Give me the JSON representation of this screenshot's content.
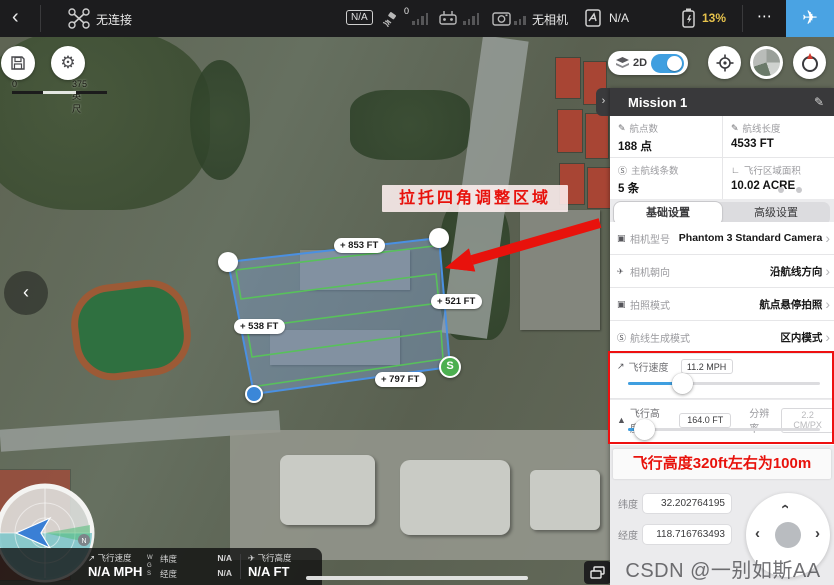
{
  "colors": {
    "accent_blue": "#3f9fe0",
    "battery_yellow": "#e6c24c",
    "alert_red": "#ee1010",
    "route_green": "#58c15b",
    "polygon_blue": "#4a90e2"
  },
  "icons": {
    "back": "‹",
    "chevron_right": "›",
    "chevron_left": "‹",
    "more": "⋯",
    "edit": "✎",
    "plane": "✈",
    "speed": "↗",
    "altitude": "▲",
    "camera": "▣",
    "heading": "✈",
    "route": "Ⓢ",
    "area": "∟",
    "pen": "✎"
  },
  "topbar": {
    "drone_status": "无连接",
    "na_badge": "N/A",
    "gps_count": "0",
    "camera_status": "无相机",
    "flight_mode": "N/A",
    "battery": "13%"
  },
  "map_controls": {
    "mode_label": "2D"
  },
  "map": {
    "scale_start": "0",
    "scale_end": "375 英尺",
    "annotation": "拉托四角调整区域",
    "edge_labels": [
      "+ 853 FT",
      "+ 521 FT",
      "+ 538 FT",
      "+ 797 FT"
    ],
    "start_marker": "S",
    "north": "N"
  },
  "panel": {
    "title": "Mission 1",
    "stats": [
      {
        "label": "航点数",
        "value": "188 点"
      },
      {
        "label": "航线长度",
        "value": "4533 FT"
      },
      {
        "label": "主航线条数",
        "value": "5 条"
      },
      {
        "label": "飞行区域面积",
        "value": "10.02 ACRE"
      }
    ],
    "tabs": [
      {
        "label": "基础设置"
      },
      {
        "label": "高级设置"
      }
    ],
    "rows": [
      {
        "label": "相机型号",
        "value": "Phantom 3 Standard Camera"
      },
      {
        "label": "相机朝向",
        "value": "沿航线方向"
      },
      {
        "label": "拍照模式",
        "value": "航点悬停拍照"
      },
      {
        "label": "航线生成模式",
        "value": "区内模式"
      }
    ],
    "speed": {
      "label": "飞行速度",
      "value": "11.2 MPH"
    },
    "altitude": {
      "label": "飞行高度",
      "value": "164.0 FT",
      "res_label": "分辨率",
      "res_value": "2.2 CM/PX"
    },
    "tip": "飞行高度320ft左右为100m",
    "coords": {
      "lat_label": "纬度",
      "lat_value": "32.202764195",
      "lon_label": "经度",
      "lon_value": "118.716763493"
    }
  },
  "telemetry": {
    "speed_label": "飞行速度",
    "speed_value": "N/A MPH",
    "wgs": "WGS",
    "lat_label": "纬度",
    "lat_value": "N/A",
    "lon_label": "经度",
    "lon_value": "N/A",
    "alt_label": "飞行高度",
    "alt_value": "N/A FT"
  },
  "watermark": "CSDN @一别如斯AA"
}
